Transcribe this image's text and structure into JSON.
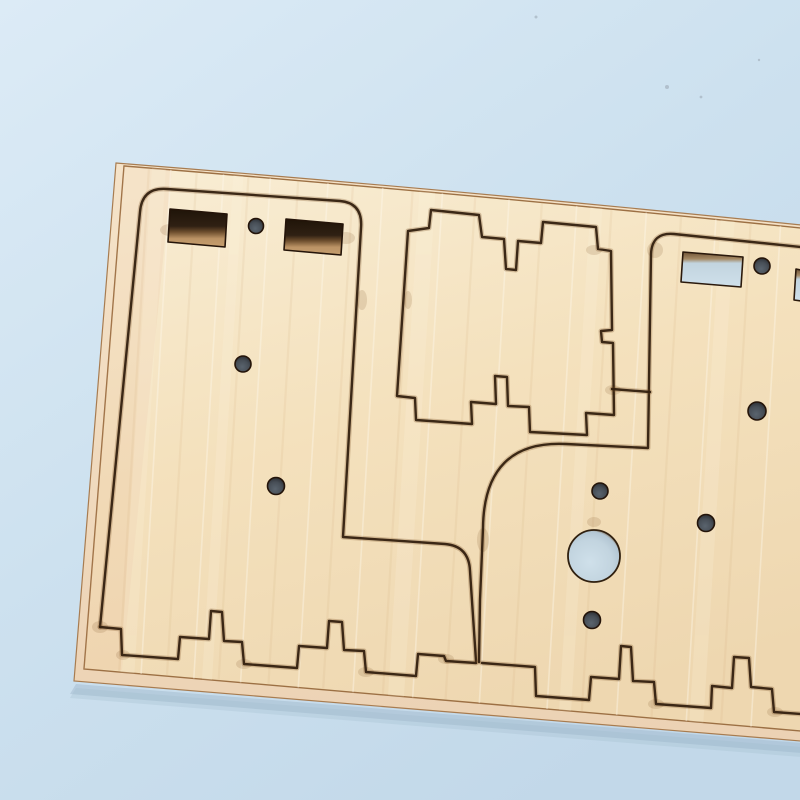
{
  "scene": {
    "description": "Close-up photo of a laser-cut plywood sheet lying at a slight angle on a light blue background. The sheet contains cut outlines of kit parts: a rounded rectangular panel on the left with two rectangular slots and small round holes, a castellated square plate in the middle, a second rounded panel on the right with a through slot, a large round through-hole showing the blue background, several small drilled holes, and a finger-joint zig-zag cut line running along the bottom of the sheet.",
    "palette": {
      "bg1": "#dcebf6",
      "bg2": "#cde1ef",
      "bg3": "#c2d8e9",
      "wood1": "#f8ecd2",
      "wood2": "#f4e1bd",
      "wood3": "#eed7b0",
      "woodSide": "#ecd2b4",
      "woodSideLight": "#f5e3c9",
      "cut": "#33200f",
      "cutSoft": "#7a5024",
      "edgeLine": "#9c7044",
      "sideEdge": "#a87c50",
      "holeDark": "#474e56",
      "holeDarkLight": "#5a646e",
      "holeDarkRim": "#241409",
      "through": "#c2d4df",
      "throughLight": "#cfe0ea",
      "slotDeep": "#1f1408",
      "slotMid": "#6b4c2c",
      "slotTan": "#c59e6e",
      "shadow": "#9db6c9",
      "pink": "#e9b695",
      "speck": "#aab8c4"
    },
    "board": {
      "surface_d": "M124,166 Q470,194 801,228 L801,731 L84,669 Z",
      "side_d": "M116,163 Q470,191 801,225 L801,741 L74,681 Z",
      "shadow_d": "M76,684 L801,743 L801,753 L70,694 Z",
      "pink_overlay_d": "M124,166 L172,170 L122,670 L84,669 Z"
    },
    "cuts": [
      {
        "name": "cut-left-panel-outline",
        "d": "M100,627 L140,212 Q142,187 167,189 L340,201 Q363,203 361,228 L343,537 L445,544 Q469,546 470,571 L476,661"
      },
      {
        "name": "cut-finger-joint-left",
        "d": "M100,627 L121,629 L122,655 L178,659 L180,637 L209,639 L211,611 L222,612 L224,641 L242,642 L244,664 L297,668 L299,646 L327,648 L329,621 L342,622 L344,650 L364,651 L366,672 L416,676 L418,654 L444,656 L446,661 L476,663"
      },
      {
        "name": "cut-finger-joint-right",
        "d": "M482,663 L535,667 L536,696 L589,700 L591,677 L619,679 L621,646 L631,647 L633,681 L654,682 L656,704 L711,708 L712,686 L732,688 L734,657 L749,658 L751,687 L772,689 L774,712 L801,714"
      },
      {
        "name": "cut-castellated-plate-outline",
        "d": "M408,231 L429,228 L431,210 L479,215 L482,237 L504,239 L506,269 L516,270 L518,241 L541,243 L543,222 L596,227 L598,249 L611,251 L612,330 L601,331 L602,342 L613,343 L614,415 L586,413 L587,435 L530,432 L529,407 L508,406 L507,377 L495,376 L496,404 L471,402 L472,424 L416,420 L415,398 L397,396 Z"
      },
      {
        "name": "cut-right-panel-outline",
        "d": "M801,247 L674,234 Q652,232 651,254 L648,448 L566,444 Q484,440 483,528 L480,600 L479,662"
      },
      {
        "name": "cut-connector",
        "d": "M612,389 L650,392"
      }
    ],
    "slots_dark": [
      {
        "name": "slot-left-panel-1",
        "points": "170,209 227,214 225,247 168,242"
      },
      {
        "name": "slot-left-panel-2",
        "points": "286,219 343,224 341,255 284,250"
      }
    ],
    "slots_through": [
      {
        "name": "slot-right-panel",
        "points": "683,252 743,257 741,287 681,282"
      },
      {
        "name": "slot-right-panel-edge",
        "points": "796,269 801,270 801,301 794,300"
      }
    ],
    "holes_dark": [
      [
        256,
        226,
        7.5
      ],
      [
        243,
        364,
        8
      ],
      [
        276,
        486,
        8.5
      ],
      [
        762,
        266,
        8
      ],
      [
        600,
        491,
        8
      ],
      [
        592,
        620,
        8.5
      ],
      [
        706,
        523,
        8.5
      ],
      [
        757,
        411,
        9
      ]
    ],
    "holes_through": [
      [
        594,
        556,
        26
      ]
    ],
    "burn_spots": [
      [
        170,
        230,
        10,
        6
      ],
      [
        346,
        238,
        9,
        6
      ],
      [
        362,
        300,
        5,
        10
      ],
      [
        100,
        627,
        8,
        6
      ],
      [
        123,
        655,
        7,
        5
      ],
      [
        244,
        664,
        8,
        5
      ],
      [
        366,
        672,
        8,
        5
      ],
      [
        446,
        659,
        8,
        5
      ],
      [
        483,
        540,
        6,
        12
      ],
      [
        655,
        250,
        8,
        8
      ],
      [
        613,
        390,
        8,
        5
      ],
      [
        656,
        704,
        8,
        5
      ],
      [
        775,
        712,
        8,
        5
      ],
      [
        594,
        522,
        7,
        5
      ],
      [
        594,
        250,
        8,
        5
      ],
      [
        408,
        300,
        4,
        9
      ]
    ],
    "grain_lines": [
      {
        "x": 150,
        "t": "d"
      },
      {
        "x": 172,
        "t": "l"
      },
      {
        "x": 198,
        "t": "d"
      },
      {
        "x": 225,
        "t": "l"
      },
      {
        "x": 250,
        "t": "d"
      },
      {
        "x": 272,
        "t": "l"
      },
      {
        "x": 300,
        "t": "d"
      },
      {
        "x": 330,
        "t": "l"
      },
      {
        "x": 355,
        "t": "d"
      },
      {
        "x": 385,
        "t": "l"
      },
      {
        "x": 415,
        "t": "d"
      },
      {
        "x": 445,
        "t": "l"
      },
      {
        "x": 478,
        "t": "d"
      },
      {
        "x": 512,
        "t": "l"
      },
      {
        "x": 545,
        "t": "d"
      },
      {
        "x": 580,
        "t": "l"
      },
      {
        "x": 615,
        "t": "d"
      },
      {
        "x": 650,
        "t": "l"
      },
      {
        "x": 685,
        "t": "d"
      },
      {
        "x": 720,
        "t": "l"
      },
      {
        "x": 755,
        "t": "d"
      },
      {
        "x": 785,
        "t": "l"
      }
    ],
    "grain_bands": [
      {
        "x": 160,
        "w": 14
      },
      {
        "x": 240,
        "w": 10
      },
      {
        "x": 430,
        "w": 16
      },
      {
        "x": 600,
        "w": 12
      },
      {
        "x": 732,
        "w": 14
      }
    ],
    "specks": [
      [
        667,
        87,
        2
      ],
      [
        701,
        97,
        1.4
      ],
      [
        536,
        17,
        1.5
      ],
      [
        759,
        60,
        1.2
      ]
    ]
  }
}
